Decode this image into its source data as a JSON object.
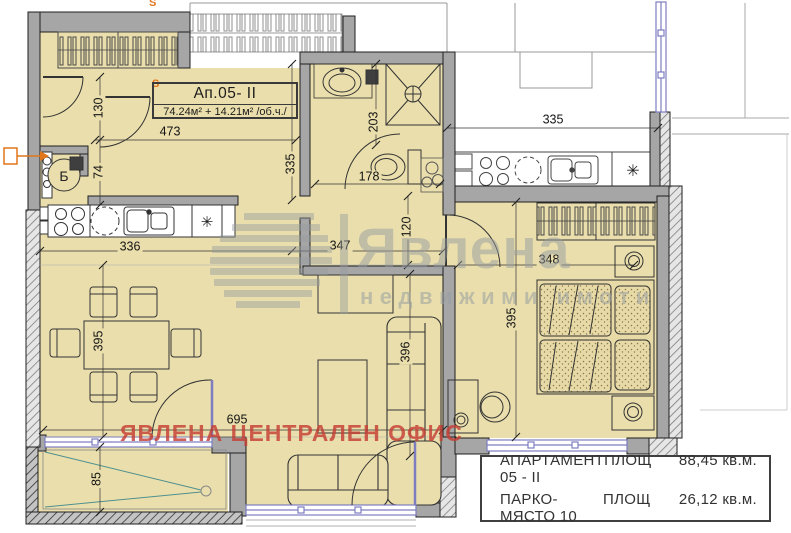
{
  "title_box": {
    "unit": "Ап.05- II",
    "area": "74.24м² + 14.21м² /об.ч./"
  },
  "labels": {
    "boiler": "Б",
    "star": "✳",
    "s_marker": "S"
  },
  "watermark": {
    "brand": "Явлена",
    "tagline": "недвижими имоти",
    "office": "ЯВЛЕНА ЦЕНТРАЛЕН ОФИС"
  },
  "info_box": {
    "rows": [
      {
        "name": "АПАРТАМЕНТ 05 - II",
        "area_label": "ПЛОЩ",
        "area_value": "88,45 кв.м."
      },
      {
        "name": "ПАРКО-МЯСТО 10",
        "area_label": "ПЛОЩ",
        "area_value": "26,12 кв.м."
      }
    ]
  },
  "dimensions": {
    "entry_door": "130",
    "hall_width": "473",
    "hall_recess": "74",
    "bath_side": "335",
    "bath_depth": "203",
    "wc_width": "178",
    "neighbor_width": "335",
    "kitchen_width": "336",
    "living_top_width": "347",
    "corridor_width": "120",
    "bedroom_width": "348",
    "living_height": "395",
    "bedroom_height": "395",
    "sofa_wall": "396",
    "living_width": "695",
    "terrace_depth": "85"
  },
  "colors": {
    "floor": "#EADFAC",
    "wall": "#A6A6A6",
    "window": "#7D7DC0",
    "accent_orange": "#E2761B",
    "watermark_gray": "#969CA0",
    "watermark_red": "#C63E34"
  }
}
